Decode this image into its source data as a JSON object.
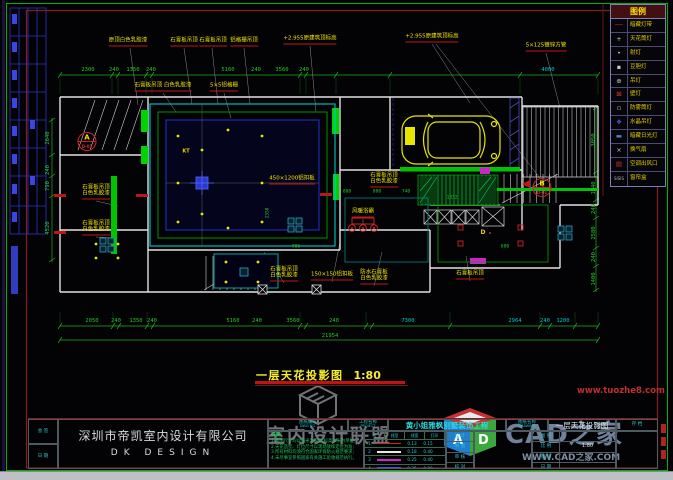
{
  "title": {
    "text": "一层天花投影图",
    "scale": "1:80"
  },
  "watermarks": {
    "union": "室内设计联盟",
    "site_red": "www.tuozhe8.com",
    "cad_name": "CAD之家",
    "cad_url": "WWW.CAD之家.COM",
    "cube_a": "A",
    "cube_d": "D"
  },
  "legend": {
    "title": "图例",
    "rows": [
      {
        "g": "──",
        "c": "#cc2626",
        "label": "暗藏灯带",
        "name": "concealed-strip-light-icon"
      },
      {
        "g": "+",
        "c": "#c8c8c8",
        "label": "天花筒灯",
        "name": "downlight-icon"
      },
      {
        "g": "•",
        "c": "#c8c8c8",
        "label": "射灯",
        "name": "spotlight-icon"
      },
      {
        "g": "▪",
        "c": "#c8c8c8",
        "label": "豆胆灯",
        "name": "bean-light-icon"
      },
      {
        "g": "⊕",
        "c": "#c8c8c8",
        "label": "吊灯",
        "name": "pendant-light-icon"
      },
      {
        "g": "⊠",
        "c": "#d83030",
        "label": "壁灯",
        "name": "wall-light-icon"
      },
      {
        "g": "▫",
        "c": "#c8c8c8",
        "label": "防雾筒灯",
        "name": "damp-proof-downlight-icon"
      },
      {
        "g": "❖",
        "c": "#4a62e8",
        "label": "水晶吊灯",
        "name": "crystal-chandelier-icon"
      },
      {
        "g": "▬",
        "c": "#5b79c8",
        "label": "暗藏日光灯",
        "name": "concealed-fluorescent-icon"
      },
      {
        "g": "×",
        "c": "#c8c8c8",
        "label": "换气扇",
        "name": "exhaust-fan-icon"
      },
      {
        "g": "▤",
        "c": "#d03030",
        "label": "空调出风口",
        "name": "ac-vent-icon"
      },
      {
        "g": "SISIS",
        "c": "#b8b8b8",
        "label": "窗帘盒",
        "name": "curtain-box-icon"
      }
    ]
  },
  "dims": [
    {
      "t": "2300",
      "x": 88,
      "y": 70
    },
    {
      "t": "240",
      "x": 114,
      "y": 70
    },
    {
      "t": "1350",
      "x": 133,
      "y": 70
    },
    {
      "t": "240",
      "x": 151,
      "y": 70
    },
    {
      "t": "5160",
      "x": 228,
      "y": 70
    },
    {
      "t": "240",
      "x": 256,
      "y": 70
    },
    {
      "t": "3560",
      "x": 282,
      "y": 70
    },
    {
      "t": "240",
      "x": 304,
      "y": 70
    },
    {
      "t": "4000",
      "x": 548,
      "y": 70,
      "c": 1
    },
    {
      "t": "2050",
      "x": 92,
      "y": 321
    },
    {
      "t": "240",
      "x": 116,
      "y": 321
    },
    {
      "t": "1350",
      "x": 136,
      "y": 321
    },
    {
      "t": "240",
      "x": 152,
      "y": 321
    },
    {
      "t": "5160",
      "x": 233,
      "y": 321
    },
    {
      "t": "240",
      "x": 257,
      "y": 321
    },
    {
      "t": "3560",
      "x": 293,
      "y": 321
    },
    {
      "t": "240",
      "x": 334,
      "y": 321
    },
    {
      "t": "7300",
      "x": 408,
      "y": 321,
      "c": 1
    },
    {
      "t": "2964",
      "x": 515,
      "y": 321,
      "c": 1
    },
    {
      "t": "240",
      "x": 545,
      "y": 321,
      "c": 1
    },
    {
      "t": "1200",
      "x": 563,
      "y": 321,
      "c": 1
    },
    {
      "t": "21954",
      "x": 330,
      "y": 336
    },
    {
      "t": "2640",
      "x": 48,
      "y": 138,
      "v": 1
    },
    {
      "t": "240",
      "x": 48,
      "y": 170,
      "v": 1
    },
    {
      "t": "790",
      "x": 48,
      "y": 186,
      "v": 1
    },
    {
      "t": "4520",
      "x": 48,
      "y": 228,
      "v": 1
    },
    {
      "t": "3050",
      "x": 594,
      "y": 140,
      "v": 1
    },
    {
      "t": "1640",
      "x": 594,
      "y": 188,
      "v": 1
    },
    {
      "t": "240",
      "x": 594,
      "y": 209,
      "v": 1
    },
    {
      "t": "2580",
      "x": 594,
      "y": 233,
      "v": 1
    },
    {
      "t": "240",
      "x": 594,
      "y": 257,
      "v": 1
    },
    {
      "t": "1400",
      "x": 594,
      "y": 279,
      "v": 1
    },
    {
      "t": "800",
      "x": 347,
      "y": 192,
      "s": 1
    },
    {
      "t": "800",
      "x": 377,
      "y": 192,
      "s": 1
    },
    {
      "t": "740",
      "x": 406,
      "y": 192,
      "s": 1
    },
    {
      "t": "2350",
      "x": 268,
      "y": 213,
      "v": 1,
      "s": 1
    },
    {
      "t": "900",
      "x": 296,
      "y": 247,
      "s": 1
    },
    {
      "t": "1332",
      "x": 452,
      "y": 198,
      "s": 1
    },
    {
      "t": "600",
      "x": 505,
      "y": 247,
      "s": 1
    }
  ],
  "callouts": [
    {
      "t": "原顶白色乳胶漆",
      "x": 128,
      "y": 46
    },
    {
      "t": "石膏板吊顶",
      "x": 184,
      "y": 46
    },
    {
      "t": "石膏板吊顶",
      "x": 213,
      "y": 46
    },
    {
      "t": "铝格栅吊顶",
      "x": 244,
      "y": 46
    },
    {
      "t": "+2.955原建筑顶标高",
      "x": 310,
      "y": 44
    },
    {
      "t": "+2.955原建筑顶标高",
      "x": 432,
      "y": 42
    },
    {
      "t": "5×125镀锌方管",
      "x": 546,
      "y": 51
    },
    {
      "t": "石膏板吊顶 白色乳胶漆",
      "x": 163,
      "y": 91
    },
    {
      "t": "5×5铝格栅",
      "x": 224,
      "y": 91
    },
    {
      "t": "石膏板吊顶",
      "x": 96,
      "y": 191,
      "u": 0
    },
    {
      "t": "白色乳胶漆",
      "x": 96,
      "y": 199
    },
    {
      "t": "石膏板吊顶",
      "x": 96,
      "y": 227,
      "u": 0
    },
    {
      "t": "白色乳胶漆",
      "x": 96,
      "y": 235
    },
    {
      "t": "450×1200铝扣板",
      "x": 292,
      "y": 184
    },
    {
      "t": "石膏板吊顶",
      "x": 384,
      "y": 179,
      "u": 0
    },
    {
      "t": "白色乳胶漆",
      "x": 384,
      "y": 187
    },
    {
      "t": "风暖浴霸",
      "x": 363,
      "y": 217
    },
    {
      "t": "石膏板吊顶",
      "x": 284,
      "y": 273,
      "u": 0
    },
    {
      "t": "白色乳胶漆",
      "x": 284,
      "y": 281
    },
    {
      "t": "150×150铝扣板",
      "x": 332,
      "y": 280
    },
    {
      "t": "防水石膏板",
      "x": 374,
      "y": 276,
      "u": 0
    },
    {
      "t": "白色乳胶漆",
      "x": 374,
      "y": 284
    },
    {
      "t": "石膏板吊顶",
      "x": 470,
      "y": 279
    }
  ],
  "codes": [
    {
      "t": "KT",
      "x": 186,
      "y": 152,
      "c": "#e8d400",
      "fs": 5
    },
    {
      "t": "D",
      "x": 483,
      "y": 233,
      "c": "#e8d400",
      "fs": 6
    },
    {
      "t": "A",
      "x": 87,
      "y": 138,
      "c": "#ffe100",
      "fs": 7
    },
    {
      "t": "D-01",
      "x": 87,
      "y": 147,
      "c": "#d03030",
      "fs": 4
    },
    {
      "t": "B",
      "x": 542,
      "y": 184,
      "c": "#ffe100",
      "fs": 7
    },
    {
      "t": "D-01",
      "x": 542,
      "y": 193,
      "c": "#d03030",
      "fs": 4
    }
  ],
  "titleblock": {
    "company": "深圳市帝凯室内设计有限公司",
    "company_en": "DK  DESIGN",
    "left_cells": [
      "会 签",
      "日 期"
    ],
    "sheet_label": "图纸编号",
    "sheet_label_en": "DWG NO.",
    "project_label": "工程名称",
    "project_label_en": "PROJECT",
    "project_name": "黄小姐雅枫别墅装饰工程",
    "drawing_label": "图纸名称",
    "drawing_label_en": "DRAWING",
    "drawing_name": "一层天花投影图",
    "file_label": "存 档",
    "notes_title": "说明:",
    "notes": [
      "1.本图尺寸均以毫米为单位,标高以米为单位;",
      "2.天花造型、灯位尺寸以现场放样定位为准;",
      "3.所有材料均须符合国家环保防火规范要求;",
      "4.未尽事宜参照国家有关施工验收规范执行。"
    ],
    "schedule": {
      "headers": [
        "号",
        "线型",
        "线宽",
        "打印"
      ],
      "rows": [
        {
          "no": "1",
          "color": "#d22222",
          "w": "0.13",
          "p": "0.15"
        },
        {
          "no": "2",
          "color": "#e8e8e8",
          "w": "0.18",
          "p": "0.40"
        },
        {
          "no": "3",
          "color": "#d222d2",
          "w": "0.25",
          "p": "0.40"
        },
        {
          "no": "4",
          "color": "#4050e0",
          "w": "0.35",
          "p": "0.00"
        }
      ]
    },
    "sign_labels": [
      "设 计",
      "制 图",
      "审 核",
      "校 对"
    ],
    "scale_cells": [
      {
        "label": "图 别",
        "value": ""
      },
      {
        "label": "比 例",
        "value": "1:80"
      },
      {
        "label": "图 号",
        "value": ""
      },
      {
        "label": "日 期",
        "value": ""
      }
    ]
  }
}
